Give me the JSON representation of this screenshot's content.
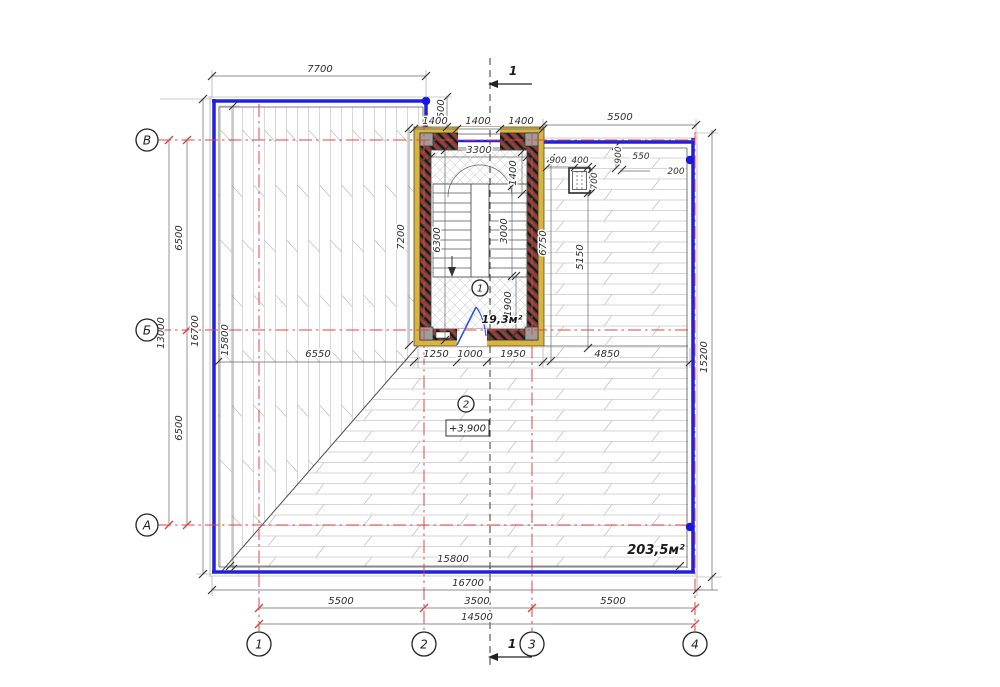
{
  "plan": {
    "type": "architectural-floor-plan",
    "areas": {
      "stairwell": "19,3м²",
      "floor": "203,5м²"
    },
    "elevation": "+3,900",
    "room_tags": {
      "stair": "1",
      "hall": "2"
    },
    "section_marks": {
      "top": "1",
      "bottom": "1"
    },
    "colors": {
      "wall_blue": "#2021dd",
      "axis_red": "#e04545",
      "insulation_yellow": "#d8b542",
      "door_blue": "#2a55e8"
    }
  },
  "axes": {
    "rows": [
      "В",
      "Б",
      "А"
    ],
    "cols": [
      "1",
      "2",
      "3",
      "4"
    ]
  },
  "dims": {
    "top_7700": "7700",
    "top_1500": "1500",
    "top_1400_left": "1400",
    "top_1400_mid": "1400",
    "top_1400_right": "1400",
    "top_5500": "5500",
    "stair_3300": "3300",
    "stair_1400": "1400",
    "stair_6300": "6300",
    "stair_3000": "3000",
    "stair_1900": "1900",
    "stair_7200": "7200",
    "shaft_900": "900",
    "shaft_400": "400",
    "shaft_900b": "900",
    "shaft_550": "550",
    "shaft_200": "200",
    "shaft_700": "700",
    "right_6750": "6750",
    "right_5150": "5150",
    "right_15200": "15200",
    "left_6500_top": "6500",
    "left_6500_bottom": "6500",
    "left_13000": "13000",
    "left_16700": "16700",
    "left_15800": "15800",
    "mid_6550": "6550",
    "mid_1250": "1250",
    "mid_1000": "1000",
    "mid_1950": "1950",
    "mid_4850": "4850",
    "bottom_15800": "15800",
    "bottom_16700": "16700",
    "bottom_5500_left": "5500",
    "bottom_3500": "3500",
    "bottom_5500_right": "5500",
    "bottom_14500": "14500"
  }
}
